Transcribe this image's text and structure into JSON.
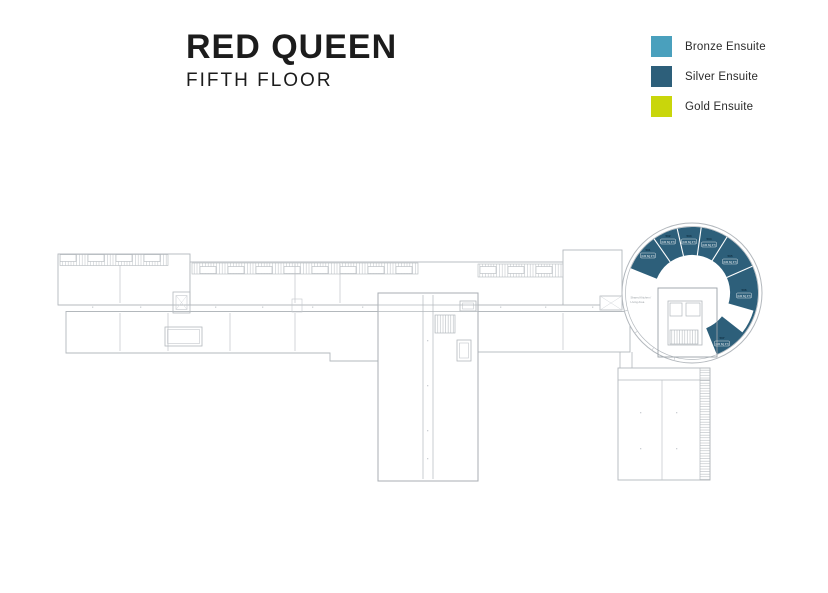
{
  "header": {
    "title": "RED QUEEN",
    "subtitle": "FIFTH FLOOR"
  },
  "legend": {
    "items": [
      {
        "label": "Bronze Ensuite",
        "color": "#4aa0bd"
      },
      {
        "label": "Silver Ensuite",
        "color": "#2d5f7a"
      },
      {
        "label": "Gold Ensuite",
        "color": "#c9d60b"
      }
    ]
  },
  "floorplan": {
    "line_color": "#b3b8bd",
    "room_fill": "#2d5f7a",
    "annotation": {
      "line1": "Shared Kitchen /",
      "line2": "Living Area"
    },
    "rooms": [
      {
        "number": "501",
        "area": "(160 SQ FT)",
        "x": 648,
        "y": 251
      },
      {
        "number": "502",
        "area": "(160 SQ FT)",
        "x": 668,
        "y": 237
      },
      {
        "number": "503",
        "area": "(160 SQ FT)",
        "x": 689,
        "y": 237
      },
      {
        "number": "504",
        "area": "(160 SQ FT)",
        "x": 709,
        "y": 240
      },
      {
        "number": "505",
        "area": "(160 SQ FT)",
        "x": 730,
        "y": 257
      },
      {
        "number": "506",
        "area": "(160 SQ FT)",
        "x": 744,
        "y": 291
      },
      {
        "number": "507",
        "area": "(160 SQ FT)",
        "x": 722,
        "y": 339
      }
    ]
  }
}
